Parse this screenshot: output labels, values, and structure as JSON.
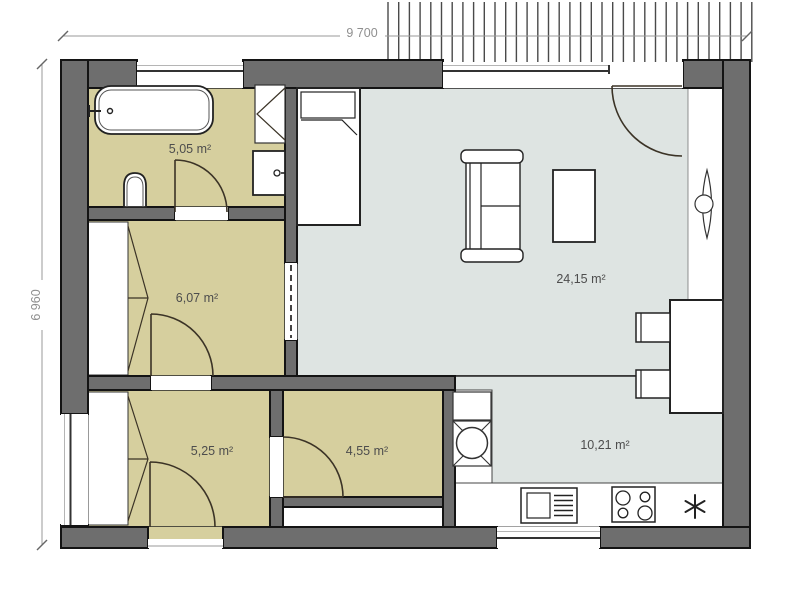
{
  "dimension_labels": {
    "horizontal": "9 700",
    "vertical": "6 960"
  },
  "rooms": [
    {
      "name": "bathroom",
      "area_label": "5,05 m²"
    },
    {
      "name": "hall-room",
      "area_label": "6,07 m²"
    },
    {
      "name": "bedroom",
      "area_label": "5,25 m²"
    },
    {
      "name": "storage-room",
      "area_label": "4,55 m²"
    },
    {
      "name": "living-room",
      "area_label": "24,15 m²"
    },
    {
      "name": "kitchen",
      "area_label": "10,21 m²"
    }
  ],
  "colors": {
    "wall_fill": "#6e6e6e",
    "wall_outline": "#141414",
    "room_floor": "#d6cf9e",
    "living_floor": "#dee4e2",
    "dimension_gray": "#8f8f8f",
    "label_gray": "#4d4d4d"
  }
}
